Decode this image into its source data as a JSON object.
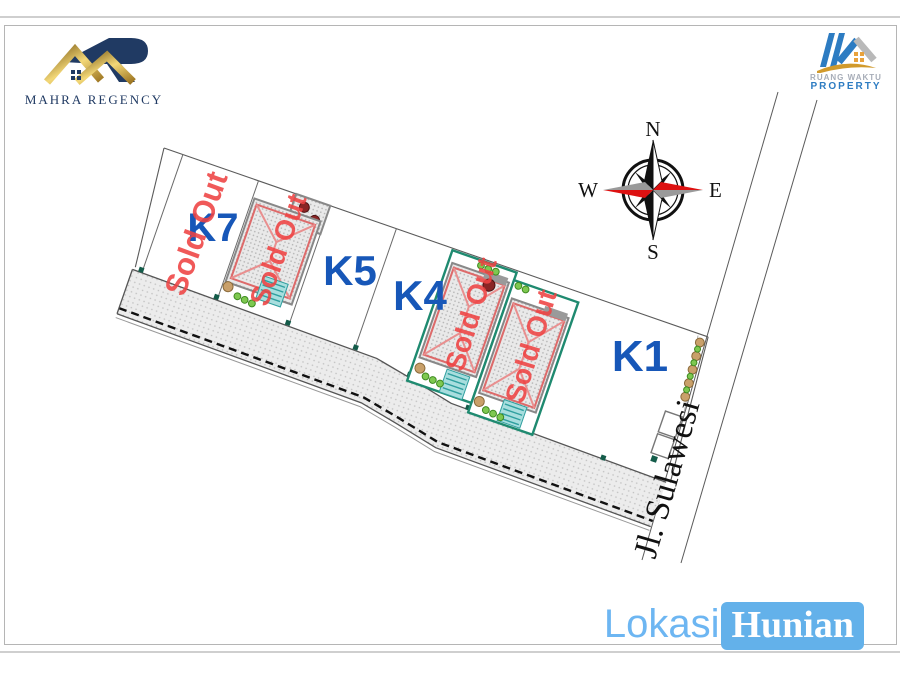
{
  "branding": {
    "left": {
      "name": "MAHRA REGENCY"
    },
    "right": {
      "line1": "RUANG WAKTU",
      "line2": "PROPERTY"
    }
  },
  "compass": {
    "north": "N",
    "east": "E",
    "south": "S",
    "west": "W"
  },
  "plan": {
    "street_label": "Jl. Sulawesi",
    "plots": [
      {
        "id": "K7",
        "label": "K7",
        "sold": true,
        "status": "Sold Out"
      },
      {
        "id": "A",
        "label": "",
        "sold": true,
        "status": "Sold Out"
      },
      {
        "id": "K5",
        "label": "K5",
        "sold": false,
        "status": ""
      },
      {
        "id": "K4",
        "label": "K4",
        "sold": false,
        "status": ""
      },
      {
        "id": "B",
        "label": "",
        "sold": true,
        "status": "Sold Out"
      },
      {
        "id": "C",
        "label": "",
        "sold": true,
        "status": "Sold Out"
      },
      {
        "id": "K1",
        "label": "K1",
        "sold": false,
        "status": ""
      }
    ],
    "colors": {
      "plot_label": "#1757b8",
      "sold_out": "#ee4343",
      "sold_plot_outline": "#1f8a70",
      "road_fill": "#ececec",
      "accent": "#63b1ea"
    }
  },
  "footer": {
    "part1": "Lokasi",
    "part2": "Hunian"
  }
}
